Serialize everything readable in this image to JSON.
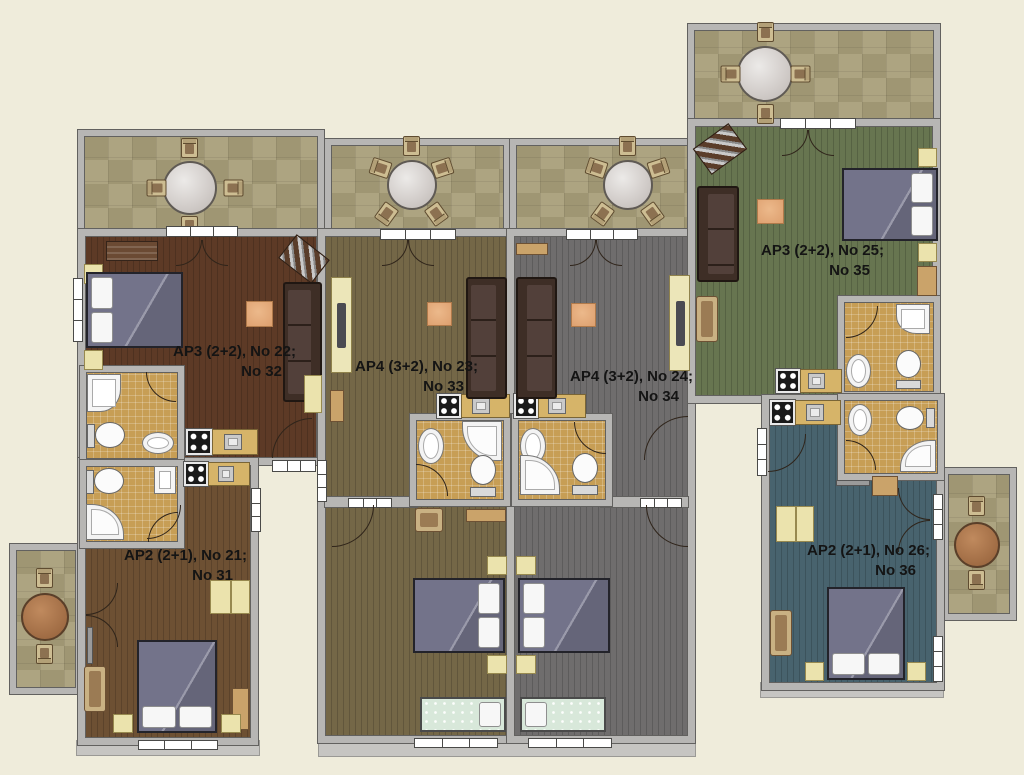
{
  "page": {
    "type": "apartment-building floor plan",
    "background_color": "#efecdb",
    "wall_color": "#b7b6b4"
  },
  "apartments": [
    {
      "id": "ap22",
      "label_line1": "AP3 (2+2), No 22;",
      "label_line2": "No 32",
      "floor_color": "#5d3a26"
    },
    {
      "id": "ap23",
      "label_line1": "AP4 (3+2), No 23;",
      "label_line2": "No 33",
      "floor_color": "#746747"
    },
    {
      "id": "ap24",
      "label_line1": "AP4 (3+2), No 24;",
      "label_line2": "No 34",
      "floor_color": "#6f6d6d"
    },
    {
      "id": "ap25",
      "label_line1": "AP3 (2+2), No 25;",
      "label_line2": "No 35",
      "floor_color": "#677550"
    },
    {
      "id": "ap21",
      "label_line1": "AP2 (2+1), No 21;",
      "label_line2": "No 31",
      "floor_color": "#6d5033"
    },
    {
      "id": "ap26",
      "label_line1": "AP2 (2+1), No 26;",
      "label_line2": "No 36",
      "floor_color": "#48636e"
    }
  ],
  "palette": {
    "balcony_tile": "#a89e79",
    "bathroom_tile": "#c79e55",
    "sofa_brown": "#3e2e26",
    "bed_blanket": "#73738a",
    "single_bed_mint": "#d8e8da",
    "rug_orange": "#dd9f6e",
    "kitchen_counter": "#d6b469",
    "cabinet_cream": "#ebe3ad"
  }
}
